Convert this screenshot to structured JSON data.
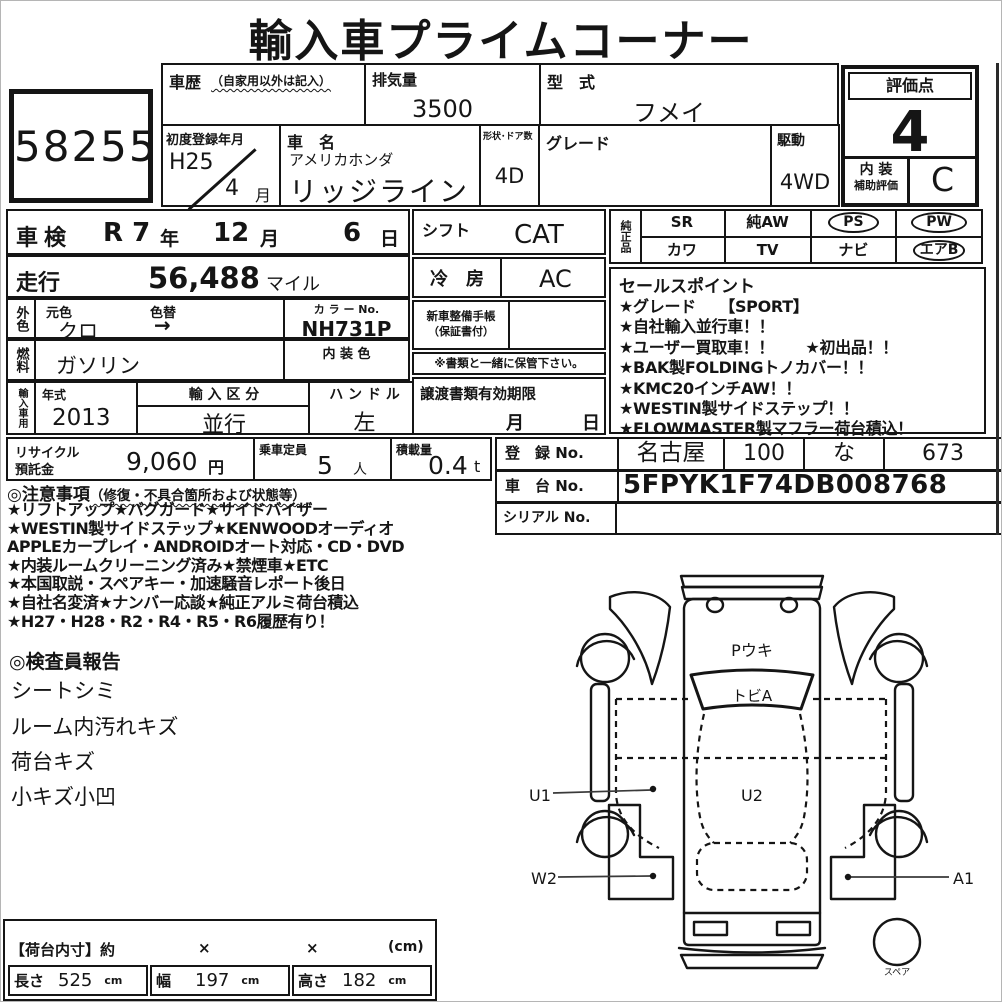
{
  "title": "輸入車プライムコーナー",
  "lot_number": "58255",
  "header_grid": {
    "history_label": "車歴",
    "history_note": "（自家用以外は記入）",
    "displacement_label": "排気量",
    "displacement_value": "3500",
    "model_code_label": "型　式",
    "model_code_value": "フメイ",
    "first_reg_label": "初度登録年月",
    "first_reg_era": "H25",
    "first_reg_month": "4",
    "first_reg_month_unit": "月",
    "car_name_label": "車　名",
    "car_maker": "アメリカホンダ",
    "car_model": "リッジライン",
    "body_doors_label": "形状･ドア数",
    "body_doors_value": "4D",
    "grade_label": "グレード",
    "drive_label": "駆動",
    "drive_value": "4WD"
  },
  "rating": {
    "label": "評価点",
    "score": "4",
    "interior_label_top": "内 装",
    "interior_label_bottom": "補助評価",
    "interior_grade": "C"
  },
  "shaken": {
    "label": "車検",
    "era": "R 7",
    "unit_year": "年",
    "month": "12",
    "unit_month": "月",
    "day": "6",
    "unit_day": "日"
  },
  "mileage": {
    "label": "走行",
    "value": "56,488",
    "unit": "マイル"
  },
  "exterior": {
    "tag": "外色",
    "base_label": "元色",
    "base_value": "クロ",
    "change_label": "色替",
    "change_value": "→",
    "color_no_label": "カ ラ ー No.",
    "color_no_value": "NH731P"
  },
  "fuel": {
    "tag": "燃料",
    "value": "ガソリン",
    "interior_color_label": "内 装 色"
  },
  "import_row": {
    "tag": "輸入車用",
    "year_label": "年式",
    "year_value": "2013",
    "class_label": "輸 入 区 分",
    "class_value": "並行",
    "handle_label": "ハ ン ド ル",
    "handle_value": "左"
  },
  "recycle_row": {
    "recycle_label_1": "リサイクル",
    "recycle_label_2": "預託金",
    "recycle_value": "9,060",
    "recycle_unit": "円",
    "capacity_label": "乗車定員",
    "capacity_value": "5",
    "capacity_unit": "人",
    "load_label": "積載量",
    "load_value": "0.4",
    "load_unit": "t"
  },
  "shift_col": {
    "shift_label": "シフト",
    "shift_value": "CAT",
    "ac_label": "冷　房",
    "ac_value": "AC",
    "maintenance_label_1": "新車整備手帳",
    "maintenance_label_2": "（保証書付）",
    "keep_note": "※書類と一緒に保管下さい。",
    "transfer_label": "譲渡書類有効期限",
    "transfer_month_unit": "月",
    "transfer_day_unit": "日"
  },
  "equipment": {
    "tag": "純正品",
    "row1": [
      "SR",
      "純AW",
      "PS",
      "PW"
    ],
    "row2": [
      "カワ",
      "TV",
      "ナビ",
      "エアB"
    ]
  },
  "sales_points": {
    "header": "セールスポイント",
    "lines": [
      "★グレード　　【SPORT】",
      "★自社輸入並行車！！",
      "★ユーザー買取車！！　　★初出品！！",
      "★BAK製FOLDINGトノカバー！！",
      "★KMC20インチAW！！",
      "★WESTIN製サイドステップ！！",
      "★FLOWMASTER製マフラー荷台積込！"
    ]
  },
  "registration": {
    "reg_label": "登　録 No.",
    "cells": [
      "名古屋",
      "100",
      "な",
      "673"
    ],
    "chassis_label": "車　台 No.",
    "chassis_value": "5FPYK1F74DB008768",
    "serial_label": "シリアル No."
  },
  "notes": {
    "header": "◎注意事項",
    "header_note": "（修復・不具合箇所および状態等）",
    "lines": [
      "★リフトアップ★バグガード★サイドバイザー",
      "★WESTIN製サイドステップ★KENWOODオーディオ",
      "APPLEカープレイ・ANDROIDオート対応・CD・DVD",
      "★内装ルームクリーニング済み★禁煙車★ETC",
      "★本国取説・スペアキー・加速騒音レポート後日",
      "★自社名変済★ナンバー応談★純正アルミ荷台積込",
      "★H27・H28・R2・R4・R5・R6履歴有り！"
    ]
  },
  "inspector_report": {
    "header": "◎検査員報告",
    "lines": [
      "シートシミ",
      "ルーム内汚れキズ",
      "荷台キズ",
      "小キズ小凹"
    ]
  },
  "bed": {
    "header": "【荷台内寸】約",
    "times": "×",
    "unit_note": "(cm)",
    "cols": [
      {
        "label": "長さ",
        "value": "525",
        "unit": "cm"
      },
      {
        "label": "幅",
        "value": "197",
        "unit": "cm"
      },
      {
        "label": "高さ",
        "value": "182",
        "unit": "cm"
      }
    ]
  },
  "diagram": {
    "hood_code": "Pウキ",
    "windshield_code": "トビA",
    "left_mid_code": "U1",
    "center_code": "U2",
    "left_rear_code": "W2",
    "right_rear_code": "A1",
    "spare_label": "スペア"
  },
  "colors": {
    "line": "#151515",
    "paper": "#ffffff"
  }
}
